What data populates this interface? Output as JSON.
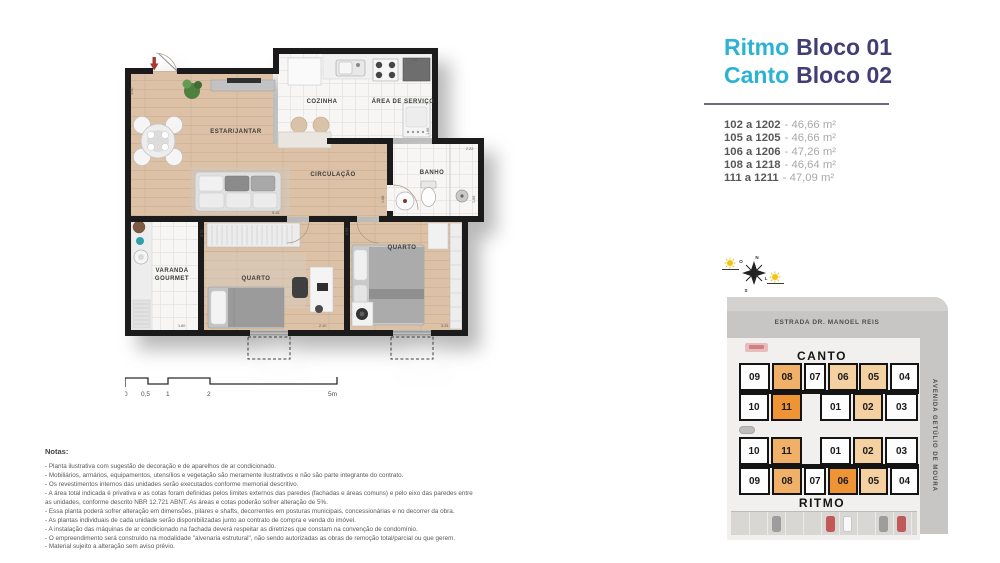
{
  "header": {
    "line1": {
      "brand": "Ritmo",
      "block": "Bloco 01"
    },
    "line2": {
      "brand": "Canto",
      "block": "Bloco 02"
    }
  },
  "units": [
    {
      "range": "102 a 1202",
      "area": "- 46,66 m²"
    },
    {
      "range": "105 a 1205",
      "area": "- 46,66 m²"
    },
    {
      "range": "106 a 1206",
      "area": "- 47,26 m²"
    },
    {
      "range": "108 a 1218",
      "area": "- 46,64 m²"
    },
    {
      "range": "111 a 1211",
      "area": "- 47,09 m²"
    }
  ],
  "plan": {
    "rooms": {
      "living": "ESTAR/JANTAR",
      "kitchen": "COZINHA",
      "service": "ÁREA DE SERVIÇO",
      "circulation": "CIRCULAÇÃO",
      "bath": "BANHO",
      "balcony_line1": "VARANDA",
      "balcony_line2": "GOURMET",
      "bedroom1": "QUARTO",
      "bedroom2": "QUARTO"
    },
    "dims": [
      "3.90",
      "1.92",
      "1.66",
      "2.22",
      "1.66",
      "1.68",
      "5.15",
      "2.93",
      "3.70",
      "1.60",
      "2.10",
      "3.25"
    ]
  },
  "scalebar": {
    "labels": [
      "0",
      "0,5",
      "1",
      "2",
      "5m"
    ]
  },
  "notes": {
    "title": "Notas:",
    "lines": [
      "- Planta ilustrativa com sugestão de decoração e de aparelhos de ar condicionado.",
      "- Mobiliários, armários, equipamentos, utensílios e vegetação são meramente ilustrativos e não são parte integrante do contrato.",
      "- Os revestimentos internos das unidades serão executados conforme memorial descritivo.",
      "- A área total indicada é privativa e as cotas foram definidas pelos limites externos das paredes (fachadas e áreas comuns) e pelo eixo das paredes entre as unidades, conforme descrito NBR 12.721 ABNT. As áreas e cotas poderão sofrer alteração de 5%.",
      "- Essa planta poderá sofrer alteração em dimensões, pilares e shafts, decorrentes em posturas municipais, concessionárias e no decorrer da obra.",
      "- As plantas individuais de cada unidade serão disponibilizadas junto ao contrato de compra e venda do imóvel.",
      "- A instalação das máquinas de ar condicionado na fachada deverá respeitar as diretrizes que constam na convenção de condomínio.",
      "- O empreendimento será construído na modalidade \"alvenaria estrutural\", não sendo autorizadas as obras de remoção total/parcial ou que gerem.",
      "- Material sujeito a alteração sem aviso prévio."
    ]
  },
  "compass": {
    "n": "N",
    "s": "S",
    "e": "L",
    "w": "O"
  },
  "sitemap": {
    "street_top": "ESTRADA DR. MANOEL REIS",
    "street_right": "AVENIDA GETÚLIO DE MOURA",
    "colors": {
      "white": "#fdfdfd",
      "light": "#f5d0a1",
      "medium": "#f1b068",
      "dark": "#ef9434"
    },
    "blocks": [
      {
        "name": "CANTO",
        "rows": [
          [
            {
              "label": "09",
              "color": "#fdfdfd"
            },
            {
              "label": "08",
              "color": "#f1b068"
            },
            {
              "label": "07",
              "color": "#fdfdfd"
            },
            {
              "label": "06",
              "color": "#f5d0a1"
            },
            {
              "label": "05",
              "color": "#f5d0a1"
            },
            {
              "label": "04",
              "color": "#fdfdfd"
            }
          ],
          [
            {
              "label": "10",
              "color": "#fdfdfd"
            },
            {
              "label": "11",
              "color": "#ef9434"
            },
            {
              "label": "01",
              "color": "#fdfdfd"
            },
            {
              "label": "02",
              "color": "#f5d0a1"
            },
            {
              "label": "03",
              "color": "#fdfdfd"
            }
          ]
        ]
      },
      {
        "name": "RITMO",
        "rows": [
          [
            {
              "label": "10",
              "color": "#fdfdfd"
            },
            {
              "label": "11",
              "color": "#f1b068"
            },
            {
              "label": "01",
              "color": "#fdfdfd"
            },
            {
              "label": "02",
              "color": "#f5d0a1"
            },
            {
              "label": "03",
              "color": "#fdfdfd"
            }
          ],
          [
            {
              "label": "09",
              "color": "#fdfdfd"
            },
            {
              "label": "08",
              "color": "#f1b068"
            },
            {
              "label": "07",
              "color": "#fdfdfd"
            },
            {
              "label": "06",
              "color": "#ef9434"
            },
            {
              "label": "05",
              "color": "#f5d0a1"
            },
            {
              "label": "04",
              "color": "#fdfdfd"
            }
          ]
        ]
      }
    ]
  }
}
